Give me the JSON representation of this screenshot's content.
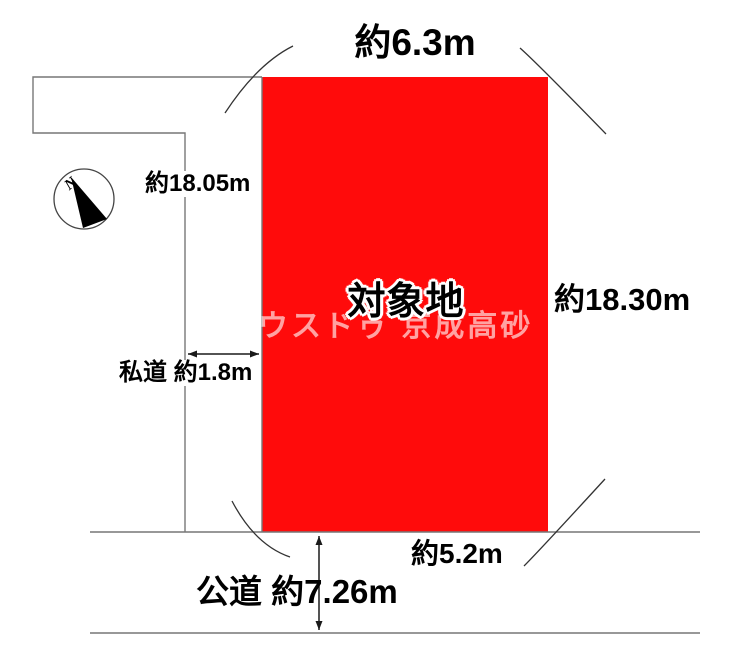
{
  "diagram": {
    "title": "land-plot-layout",
    "plot": {
      "label": "対象地",
      "fill_color": "#ff0b0b"
    },
    "watermark": "ウスドゥ 京成高砂",
    "compass": {
      "north_label": "N"
    },
    "dimensions": {
      "top": "約6.3m",
      "right": "約18.30m",
      "left": "約18.05m",
      "bottom": "約5.2m"
    },
    "roads": {
      "private_road": "私道 約1.8m",
      "public_road": "公道 約7.26m"
    },
    "colors": {
      "boundary_line": "#777777",
      "arc_line": "#333333",
      "arrow_line": "#1a1a1a",
      "text": "#000000"
    }
  }
}
